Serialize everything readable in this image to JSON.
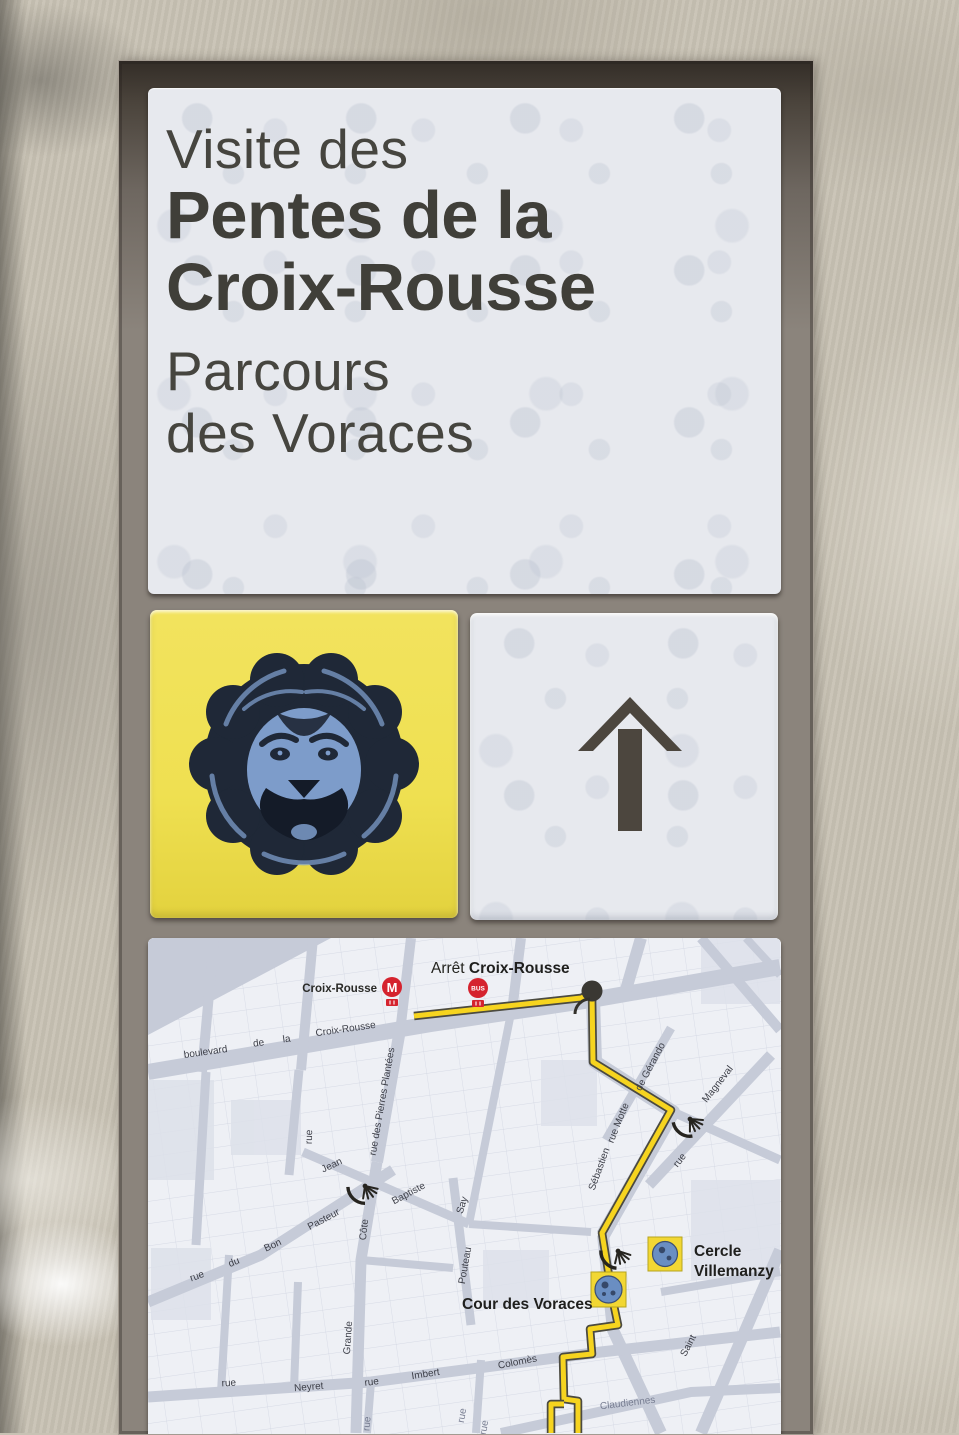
{
  "sign": {
    "title_line1": "Visite des",
    "title_line2": "Pentes de la",
    "title_line3": "Croix-Rousse",
    "subtitle_line1": "Parcours",
    "subtitle_line2": "des Voraces"
  },
  "tiles": {
    "lion": {
      "description": "blue lion head medallion on yellow tile",
      "tile_color": "#efe051",
      "lion_blue": "#7d9cca",
      "lion_dark": "#1f2837"
    },
    "arrow": {
      "direction": "up",
      "arrow_color": "#4c463e",
      "tile_color": "#e9edf2"
    }
  },
  "map": {
    "colors": {
      "street": "#c6cbd8",
      "block": "#eef0f5",
      "route_yellow": "#f6d41f",
      "route_outline": "#4b4a40",
      "transit_red": "#d5232e",
      "poi_square": "#f2d733",
      "poi_medallion": "#6a8ec2"
    },
    "stop": {
      "arret_prefix": "Arrêt ",
      "arret_name": "Croix-Rousse",
      "station_label": "Croix-Rousse",
      "metro_label": "M",
      "bus_label": "BUS"
    },
    "pois": [
      {
        "name": "Cercle Villemanzy",
        "label_line1": "Cercle",
        "label_line2": "Villemanzy"
      },
      {
        "name": "Cour des Voraces",
        "label": "Cour des Voraces"
      }
    ],
    "street_labels": [
      {
        "t": "boulevard"
      },
      {
        "t": "de"
      },
      {
        "t": "la"
      },
      {
        "t": "Croix-Rousse"
      },
      {
        "t": "rue"
      },
      {
        "t": "rue des Pierres Plantées"
      },
      {
        "t": "Jean"
      },
      {
        "t": "Baptiste"
      },
      {
        "t": "Say"
      },
      {
        "t": "rue"
      },
      {
        "t": "du"
      },
      {
        "t": "Bon"
      },
      {
        "t": "Pasteur"
      },
      {
        "t": "Côte"
      },
      {
        "t": "Grande"
      },
      {
        "t": "Pouteau"
      },
      {
        "t": "rue"
      },
      {
        "t": "Neyret"
      },
      {
        "t": "rue"
      },
      {
        "t": "Imbert"
      },
      {
        "t": "Colomès"
      },
      {
        "t": "Sébastien"
      },
      {
        "t": "Saint"
      },
      {
        "t": "rue Motte"
      },
      {
        "t": "de Gérando"
      },
      {
        "t": "rue"
      },
      {
        "t": "Magneval"
      },
      {
        "t": "Claudiennes"
      },
      {
        "t": "rue"
      },
      {
        "t": "rue"
      },
      {
        "t": "rue"
      }
    ]
  }
}
